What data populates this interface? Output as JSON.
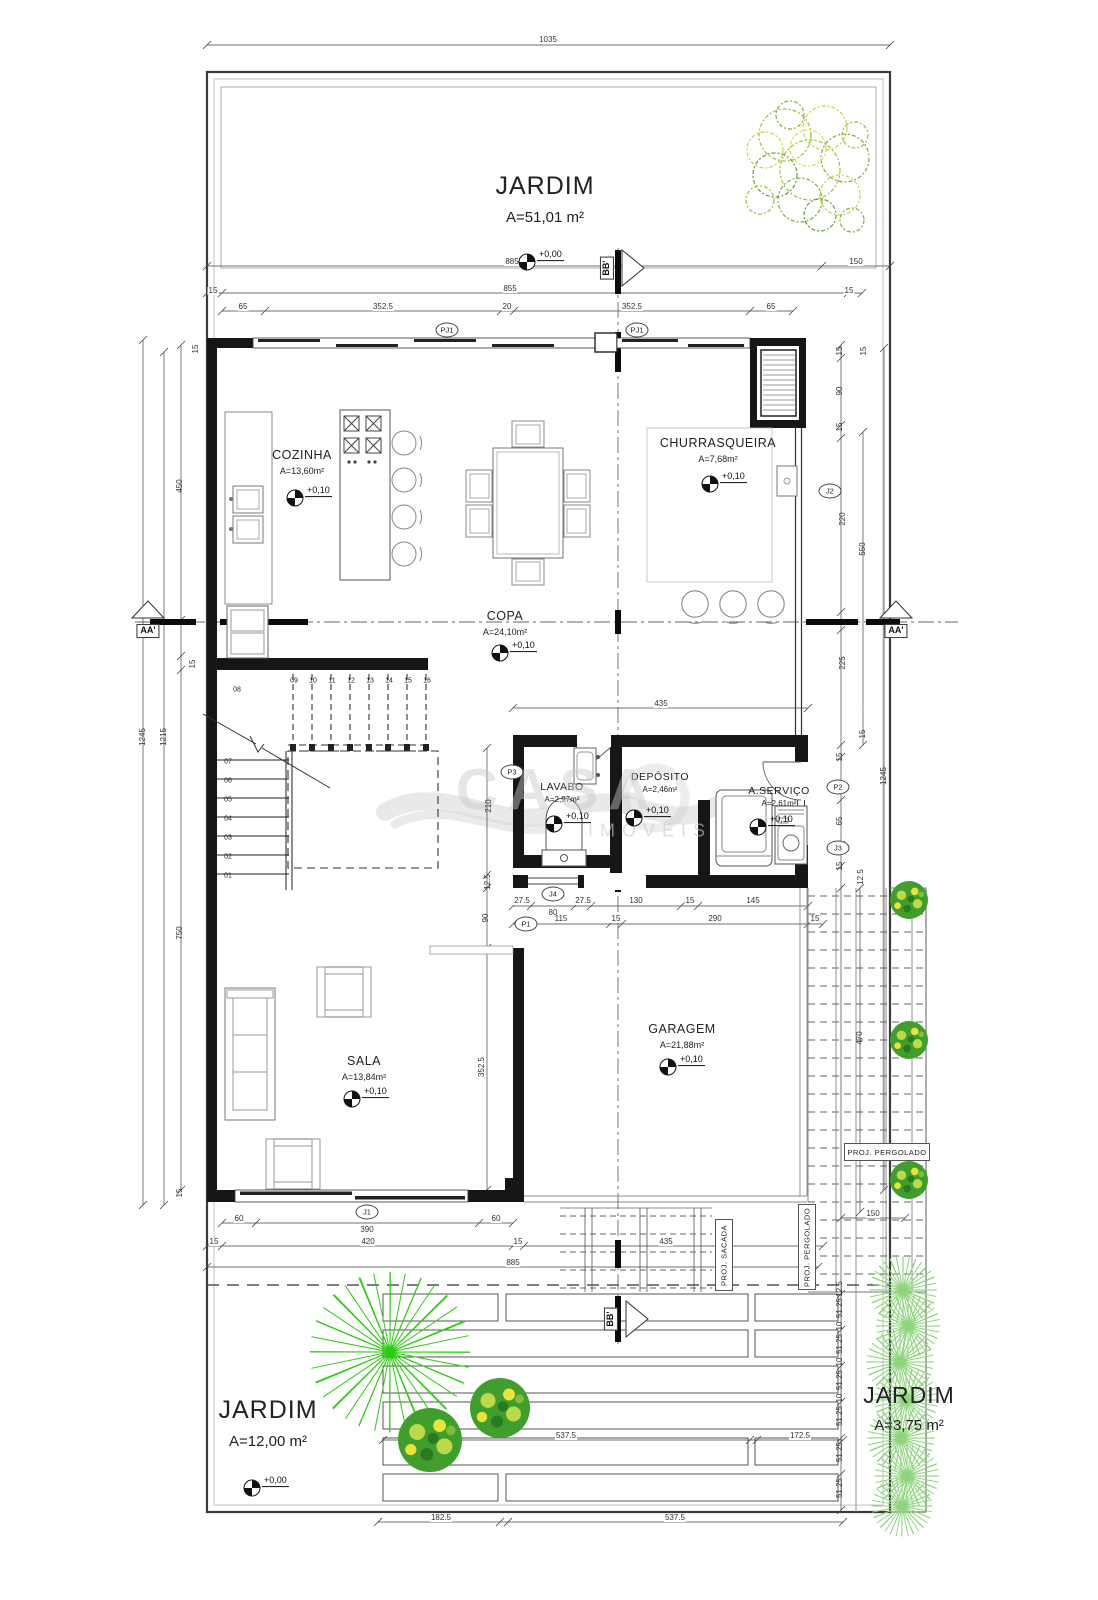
{
  "watermark": {
    "brand": "CASA",
    "subtitle": "IMÓVEIS"
  },
  "gardens": {
    "top": {
      "name": "JARDIM",
      "area": "A=51,01 m²"
    },
    "bottom_left": {
      "name": "JARDIM",
      "area": "A=12,00 m²"
    },
    "bottom_right": {
      "name": "JARDIM",
      "area": "A=3,75 m²"
    }
  },
  "rooms": {
    "cozinha": {
      "name": "COZINHA",
      "area": "A=13,60m²"
    },
    "churrasqueira": {
      "name": "CHURRASQUEIRA",
      "area": "A=7,68m²"
    },
    "copa": {
      "name": "COPA",
      "area": "A=24,10m²"
    },
    "lavabo": {
      "name": "LAVABO",
      "area": "A=2,97m²"
    },
    "deposito": {
      "name": "DEPÓSITO",
      "area": "A=2,46m²"
    },
    "servico": {
      "name": "A.SERVIÇO",
      "area": "A=2,61m²"
    },
    "sala": {
      "name": "SALA",
      "area": "A=13,84m²"
    },
    "garagem": {
      "name": "GARAGEM",
      "area": "A=21,88m²"
    }
  },
  "projections": {
    "sacada": "PROJ. SACADA",
    "pergolado": "PROJ. PERGOLADO"
  },
  "level_markers": [
    {
      "t": "+0,00",
      "x": 527,
      "y": 262
    },
    {
      "t": "+0,10",
      "x": 295,
      "y": 498
    },
    {
      "t": "+0,10",
      "x": 710,
      "y": 484
    },
    {
      "t": "+0,10",
      "x": 500,
      "y": 653
    },
    {
      "t": "+0,10",
      "x": 554,
      "y": 824
    },
    {
      "t": "+0,10",
      "x": 634,
      "y": 818
    },
    {
      "t": "+0,10",
      "x": 758,
      "y": 827
    },
    {
      "t": "+0,10",
      "x": 352,
      "y": 1099
    },
    {
      "t": "+0,10",
      "x": 668,
      "y": 1067
    },
    {
      "t": "+0,00",
      "x": 252,
      "y": 1488
    }
  ],
  "markers_circled": [
    {
      "t": "PJ1",
      "x": 447,
      "y": 330
    },
    {
      "t": "PJ1",
      "x": 637,
      "y": 330
    },
    {
      "t": "J2",
      "x": 830,
      "y": 491
    },
    {
      "t": "P3",
      "x": 512,
      "y": 772
    },
    {
      "t": "P2",
      "x": 838,
      "y": 787
    },
    {
      "t": "J3",
      "x": 838,
      "y": 848
    },
    {
      "t": "J4",
      "x": 553,
      "y": 894
    },
    {
      "t": "P1",
      "x": 526,
      "y": 924
    },
    {
      "t": "J1",
      "x": 367,
      "y": 1212
    }
  ],
  "markers_boxed": [
    {
      "t": "AA'",
      "x": 148,
      "y": 631
    },
    {
      "t": "AA'",
      "x": 896,
      "y": 631
    },
    {
      "t": "BB'",
      "x": 607,
      "y": 268,
      "v": 1
    },
    {
      "t": "BB'",
      "x": 611,
      "y": 1319,
      "v": 1
    }
  ],
  "plan_labels": [
    {
      "t": "1035",
      "x": 548,
      "y": 40
    },
    {
      "t": "885",
      "x": 512,
      "y": 262
    },
    {
      "t": "150",
      "x": 856,
      "y": 262
    },
    {
      "t": "855",
      "x": 510,
      "y": 289
    },
    {
      "t": "15",
      "x": 213,
      "y": 291
    },
    {
      "t": "15",
      "x": 849,
      "y": 291
    },
    {
      "t": "65",
      "x": 243,
      "y": 307
    },
    {
      "t": "352.5",
      "x": 383,
      "y": 307
    },
    {
      "t": "20",
      "x": 507,
      "y": 307
    },
    {
      "t": "352.5",
      "x": 632,
      "y": 307
    },
    {
      "t": "65",
      "x": 771,
      "y": 307
    },
    {
      "t": "15",
      "x": 196,
      "y": 349,
      "v": 1
    },
    {
      "t": "450",
      "x": 180,
      "y": 486,
      "v": 1
    },
    {
      "t": "15",
      "x": 193,
      "y": 664,
      "v": 1
    },
    {
      "t": "1245",
      "x": 143,
      "y": 737,
      "v": 1
    },
    {
      "t": "1215",
      "x": 164,
      "y": 737,
      "v": 1
    },
    {
      "t": "750",
      "x": 180,
      "y": 933,
      "v": 1
    },
    {
      "t": "15",
      "x": 180,
      "y": 1193,
      "v": 1
    },
    {
      "t": "15",
      "x": 840,
      "y": 351,
      "v": 1
    },
    {
      "t": "15",
      "x": 864,
      "y": 351,
      "v": 1
    },
    {
      "t": "90",
      "x": 840,
      "y": 391,
      "v": 1
    },
    {
      "t": "15",
      "x": 840,
      "y": 427,
      "v": 1
    },
    {
      "t": "220",
      "x": 843,
      "y": 519,
      "v": 1
    },
    {
      "t": "550",
      "x": 863,
      "y": 549,
      "v": 1
    },
    {
      "t": "225",
      "x": 843,
      "y": 663,
      "v": 1
    },
    {
      "t": "15",
      "x": 863,
      "y": 734,
      "v": 1
    },
    {
      "t": "15",
      "x": 840,
      "y": 757,
      "v": 1
    },
    {
      "t": "1245",
      "x": 884,
      "y": 776,
      "v": 1
    },
    {
      "t": "65",
      "x": 840,
      "y": 821,
      "v": 1
    },
    {
      "t": "15",
      "x": 840,
      "y": 866,
      "v": 1
    },
    {
      "t": "12.5",
      "x": 861,
      "y": 877,
      "v": 1
    },
    {
      "t": "435",
      "x": 661,
      "y": 704
    },
    {
      "t": "210",
      "x": 489,
      "y": 806,
      "v": 1
    },
    {
      "t": "12.5",
      "x": 488,
      "y": 882,
      "v": 1
    },
    {
      "t": "90",
      "x": 486,
      "y": 918,
      "v": 1
    },
    {
      "t": "27.5",
      "x": 522,
      "y": 901
    },
    {
      "t": "80",
      "x": 553,
      "y": 913
    },
    {
      "t": "27.5",
      "x": 583,
      "y": 901
    },
    {
      "t": "130",
      "x": 636,
      "y": 901
    },
    {
      "t": "15",
      "x": 690,
      "y": 901
    },
    {
      "t": "145",
      "x": 753,
      "y": 901
    },
    {
      "t": "115",
      "x": 561,
      "y": 919
    },
    {
      "t": "15",
      "x": 616,
      "y": 919
    },
    {
      "t": "290",
      "x": 715,
      "y": 919
    },
    {
      "t": "15",
      "x": 815,
      "y": 919
    },
    {
      "t": "352.5",
      "x": 482,
      "y": 1067,
      "v": 1
    },
    {
      "t": "470",
      "x": 860,
      "y": 1038,
      "v": 1
    },
    {
      "t": "150",
      "x": 873,
      "y": 1214
    },
    {
      "t": "60",
      "x": 239,
      "y": 1219
    },
    {
      "t": "390",
      "x": 367,
      "y": 1230
    },
    {
      "t": "60",
      "x": 496,
      "y": 1219
    },
    {
      "t": "15",
      "x": 214,
      "y": 1242
    },
    {
      "t": "420",
      "x": 368,
      "y": 1242
    },
    {
      "t": "15",
      "x": 518,
      "y": 1242
    },
    {
      "t": "435",
      "x": 666,
      "y": 1242
    },
    {
      "t": "885",
      "x": 513,
      "y": 1263
    },
    {
      "t": "12.5",
      "x": 840,
      "y": 1289,
      "v": 1
    },
    {
      "t": "51.25",
      "x": 840,
      "y": 1308,
      "v": 1
    },
    {
      "t": "10",
      "x": 840,
      "y": 1326,
      "v": 1
    },
    {
      "t": "51.25",
      "x": 840,
      "y": 1344,
      "v": 1
    },
    {
      "t": "10",
      "x": 840,
      "y": 1362,
      "v": 1
    },
    {
      "t": "51.25",
      "x": 840,
      "y": 1380,
      "v": 1
    },
    {
      "t": "10",
      "x": 840,
      "y": 1398,
      "v": 1
    },
    {
      "t": "51.25",
      "x": 840,
      "y": 1416,
      "v": 1
    },
    {
      "t": "51.25",
      "x": 840,
      "y": 1452,
      "v": 1
    },
    {
      "t": "51.25",
      "x": 840,
      "y": 1488,
      "v": 1
    },
    {
      "t": "537.5",
      "x": 566,
      "y": 1436
    },
    {
      "t": "172.5",
      "x": 800,
      "y": 1436
    },
    {
      "t": "182.5",
      "x": 441,
      "y": 1518
    },
    {
      "t": "537.5",
      "x": 675,
      "y": 1518
    },
    {
      "t": "08",
      "x": 237,
      "y": 690,
      "c": "st"
    },
    {
      "t": "09",
      "x": 294,
      "y": 681,
      "c": "st"
    },
    {
      "t": "10",
      "x": 313,
      "y": 681,
      "c": "st"
    },
    {
      "t": "11",
      "x": 332,
      "y": 681,
      "c": "st"
    },
    {
      "t": "12",
      "x": 351,
      "y": 681,
      "c": "st"
    },
    {
      "t": "13",
      "x": 370,
      "y": 681,
      "c": "st"
    },
    {
      "t": "14",
      "x": 389,
      "y": 681,
      "c": "st"
    },
    {
      "t": "15",
      "x": 408,
      "y": 681,
      "c": "st"
    },
    {
      "t": "16",
      "x": 427,
      "y": 681,
      "c": "st"
    },
    {
      "t": "07",
      "x": 228,
      "y": 762,
      "c": "st"
    },
    {
      "t": "06",
      "x": 228,
      "y": 781,
      "c": "st"
    },
    {
      "t": "05",
      "x": 228,
      "y": 800,
      "c": "st"
    },
    {
      "t": "04",
      "x": 228,
      "y": 819,
      "c": "st"
    },
    {
      "t": "03",
      "x": 228,
      "y": 838,
      "c": "st"
    },
    {
      "t": "02",
      "x": 228,
      "y": 857,
      "c": "st"
    },
    {
      "t": "01",
      "x": 228,
      "y": 876,
      "c": "st"
    }
  ]
}
